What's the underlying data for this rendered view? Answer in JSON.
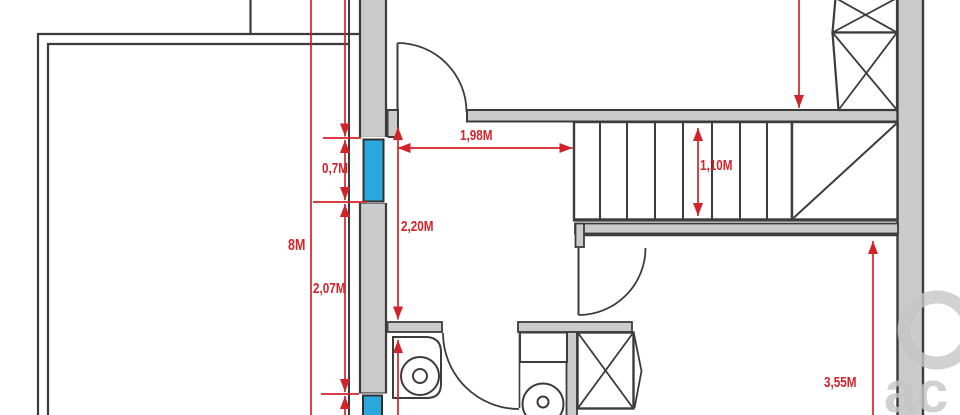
{
  "figure": {
    "kind_label": "",
    "colors": {
      "dimension_red": "#d2232a",
      "wall_fill": "#cbcbcb",
      "wall_line": "#3c3c3c",
      "window_blue": "#2aa7dc",
      "watermark_gray": "#c6c6c6"
    },
    "dimensions": {
      "d8m": {
        "label": "8M"
      },
      "d07": {
        "label": "0,7M"
      },
      "d207": {
        "label": "2,07M"
      },
      "d198": {
        "label": "1,98M"
      },
      "d220": {
        "label": "2,20M"
      },
      "d110": {
        "label": "1,10M"
      },
      "d355": {
        "label": "3,55M"
      }
    },
    "watermark": {
      "text": "ac"
    }
  }
}
